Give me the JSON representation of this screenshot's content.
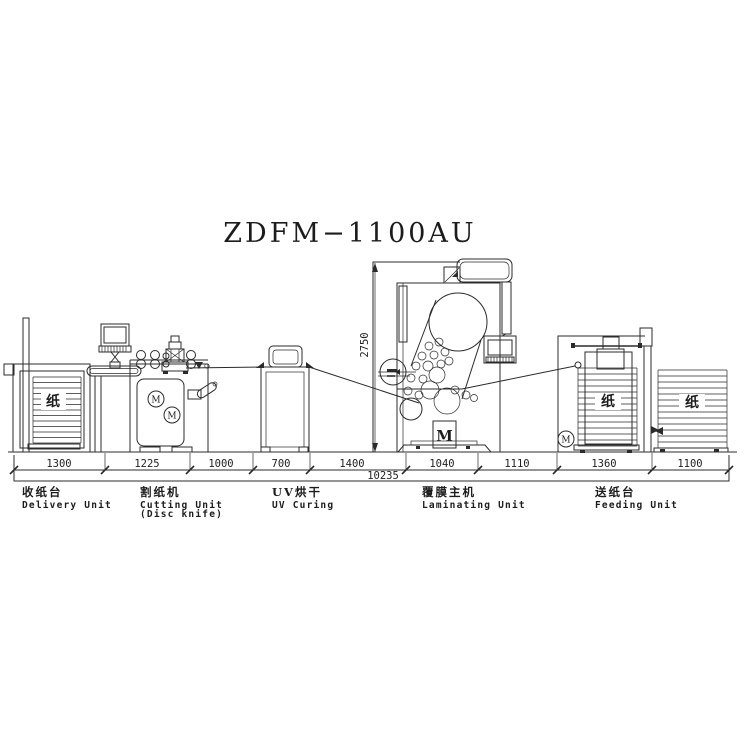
{
  "title": "ZDFM−1100AU",
  "dimensions": {
    "segments": [
      "1300",
      "1225",
      "1000",
      "700",
      "1400",
      "1040",
      "1110",
      "1360",
      "1100"
    ],
    "total": "10235",
    "height": "2750"
  },
  "units": {
    "delivery": {
      "zh": "收纸台",
      "en": "Delivery Unit"
    },
    "cutting": {
      "zh": "割纸机",
      "en": "Cutting Unit",
      "en2": "(Disc knife)"
    },
    "uv": {
      "zh": "UV烘干",
      "en": "UV Curing"
    },
    "laminating": {
      "zh": "覆膜主机",
      "en": "Laminating Unit"
    },
    "feeding": {
      "zh": "送纸台",
      "en": "Feeding Unit"
    }
  },
  "glyphs": {
    "paper": "纸",
    "motor": "M"
  },
  "colors": {
    "line": "#2b2b2b",
    "background": "#ffffff"
  }
}
